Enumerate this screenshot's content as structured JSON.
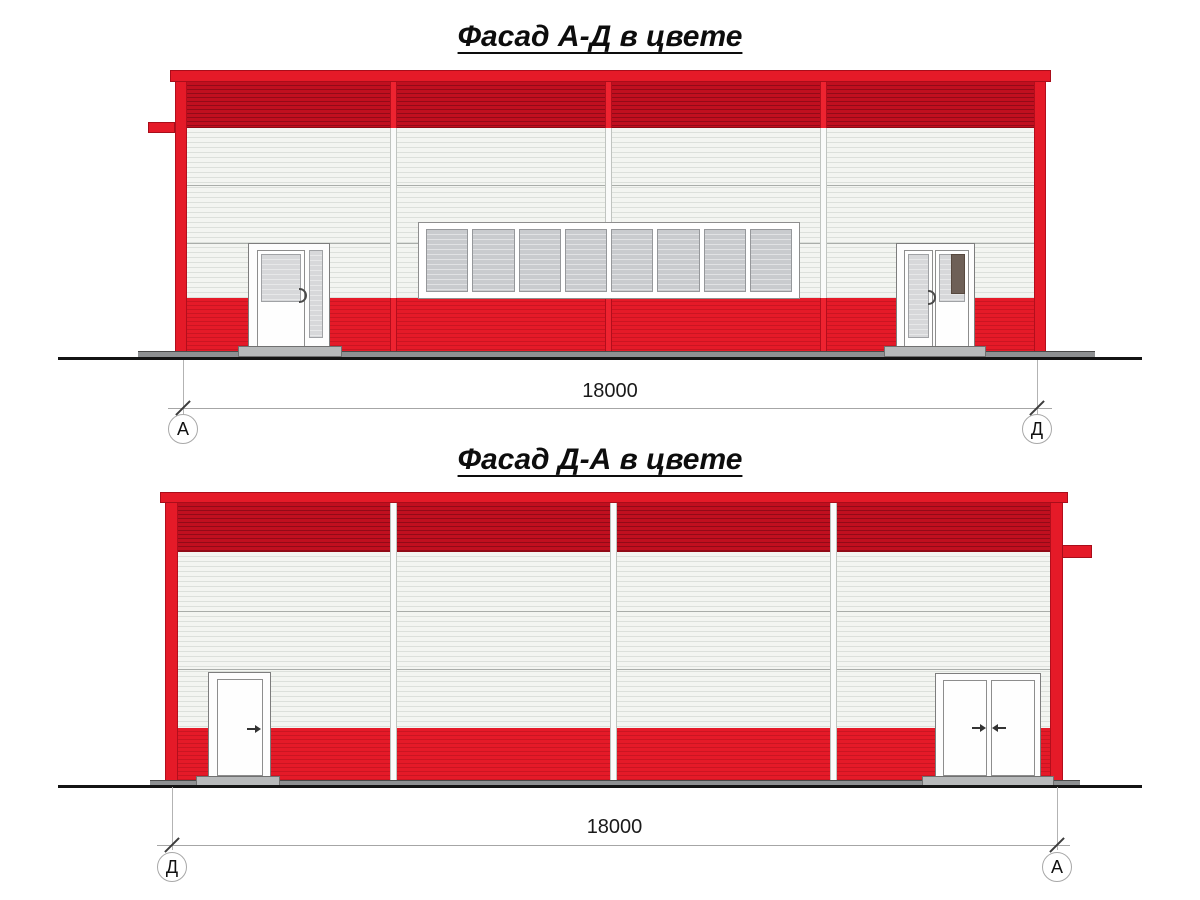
{
  "document": {
    "background": "#ffffff"
  },
  "colors": {
    "bright_red": "#e51a28",
    "dark_red": "#c10f1f",
    "panel_white": "#f3f5f1",
    "glass_gray": "#c9cbce",
    "door_dark_panel": "#6e6057",
    "plinth_gray": "#8e9092",
    "ground_black": "#141414",
    "dimension_gray": "#a6a6a6"
  },
  "facade_top": {
    "title": "Фасад А-Д в цвете",
    "dimension_label": "18000",
    "axis_left_label": "А",
    "axis_right_label": "Д"
  },
  "facade_bottom": {
    "title": "Фасад Д-А в цвете",
    "dimension_label": "18000",
    "axis_left_label": "Д",
    "axis_right_label": "А"
  }
}
